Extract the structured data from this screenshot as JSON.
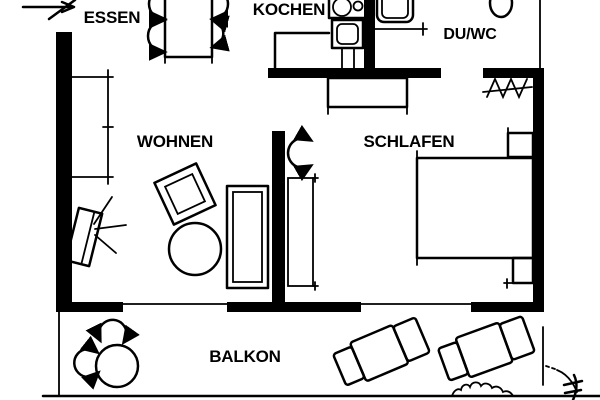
{
  "canvas": {
    "background": "#ffffff",
    "line_color": "#000000",
    "width": 600,
    "height": 400
  },
  "rooms": [
    {
      "id": "essen",
      "label": "ESSEN"
    },
    {
      "id": "kochen",
      "label": "KOCHEN"
    },
    {
      "id": "duwc",
      "label": "DU/WC"
    },
    {
      "id": "wohnen",
      "label": "WOHNEN"
    },
    {
      "id": "schlafen",
      "label": "SCHLAFEN"
    },
    {
      "id": "balkon",
      "label": "BALKON"
    }
  ],
  "icons": {
    "entrance": "entrance-arrow-icon",
    "essen": [
      "dining-table",
      "dining-chair-icon"
    ],
    "kochen": [
      "stove-icon",
      "kitchen-sink-icon",
      "counter-outline"
    ],
    "duwc": [
      "shower-icon",
      "toilet-icon"
    ],
    "schlafen": [
      "double-bed",
      "nightstand",
      "wardrobe",
      "dresser",
      "door-swing-icon",
      "zigzag-wardrobe-icon"
    ],
    "wohnen": [
      "sofa",
      "armchair",
      "coffee-table",
      "tv-icon",
      "radiator-cabinet"
    ],
    "balkon": [
      "round-table",
      "balcony-chair-icon",
      "sun-lounger",
      "plant-icon"
    ]
  }
}
